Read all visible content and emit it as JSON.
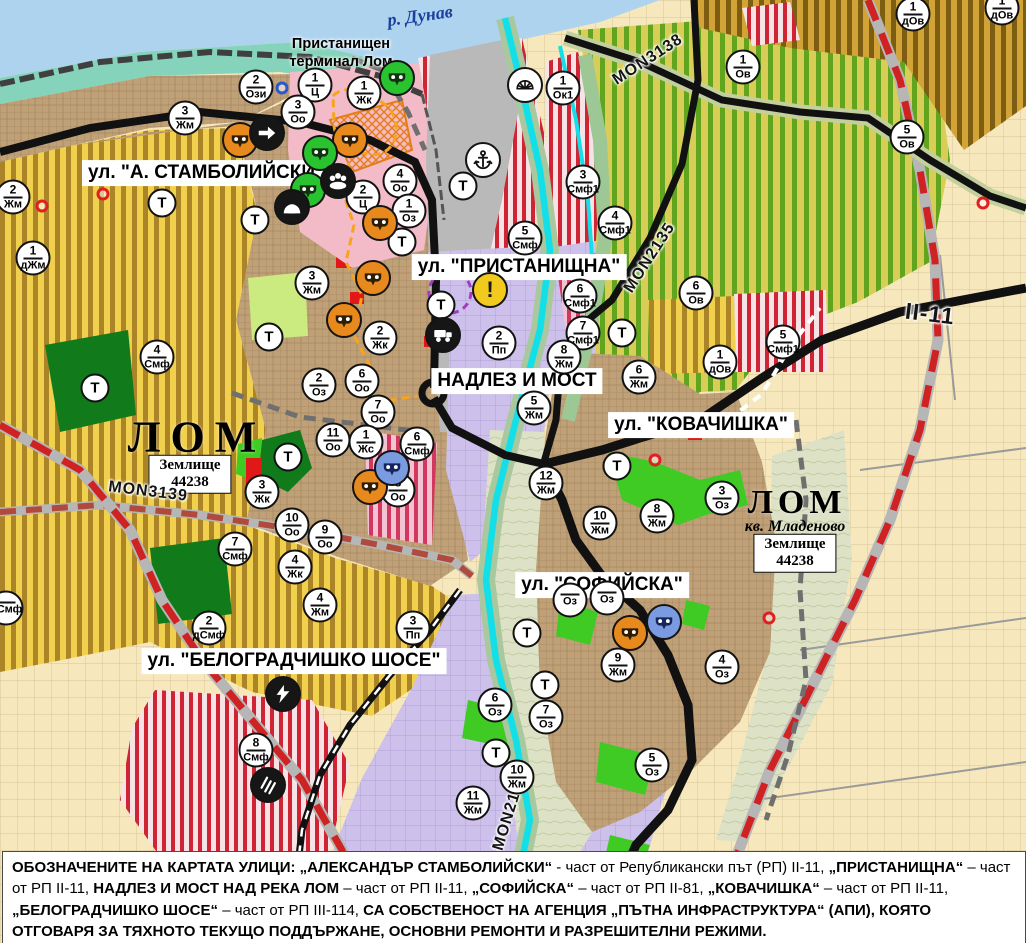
{
  "map": {
    "labels": {
      "danube": "р. Дунав",
      "port_line1": "Пристанищен",
      "port_line2": "терминал Лом",
      "lom1": "ЛОМ",
      "lom2": "ЛОМ",
      "mladenovo": "кв. Младеново",
      "zem_line1": "Землище",
      "zem_line2": "44238"
    },
    "street_labels": [
      {
        "text": "ул. \"А. СТАМБОЛИЙСКИ\"",
        "cx": 206,
        "cy": 173
      },
      {
        "text": "ул. \"ПРИСТАНИЩНА\"",
        "cx": 519,
        "cy": 267
      },
      {
        "text": "НАДЛЕЗ И МОСТ",
        "cx": 517,
        "cy": 381
      },
      {
        "text": "ул. \"КОВАЧИШКА\"",
        "cx": 701,
        "cy": 425
      },
      {
        "text": "ул. \"СОФИЙСКА\"",
        "cx": 602,
        "cy": 585
      },
      {
        "text": "ул. \"БЕЛОГРАДЧИШКО ШОСЕ\"",
        "cx": 294,
        "cy": 661
      }
    ],
    "road_labels": [
      {
        "text": "MON3139",
        "cx": 148,
        "cy": 492,
        "angle": 7,
        "big": false
      },
      {
        "text": "MON2135",
        "cx": 650,
        "cy": 258,
        "angle": -57,
        "big": false
      },
      {
        "text": "MON3138",
        "cx": 648,
        "cy": 60,
        "angle": -33,
        "big": false
      },
      {
        "text": "MON2136",
        "cx": 510,
        "cy": 812,
        "angle": -73,
        "big": false
      },
      {
        "text": "II-11",
        "cx": 930,
        "cy": 314,
        "angle": 7,
        "big": true
      }
    ],
    "t_marker_label": "Т",
    "zone_markers": [
      {
        "n": "2",
        "a": "Ози",
        "x": 256,
        "y": 87
      },
      {
        "n": "1",
        "a": "Ц",
        "x": 315,
        "y": 85
      },
      {
        "n": "3",
        "a": "Оо",
        "x": 298,
        "y": 112
      },
      {
        "n": "1",
        "a": "Жк",
        "x": 364,
        "y": 93
      },
      {
        "n": "3",
        "a": "Жм",
        "x": 185,
        "y": 118
      },
      {
        "n": "4",
        "a": "Оо",
        "x": 400,
        "y": 181
      },
      {
        "n": "2",
        "a": "Ц",
        "x": 363,
        "y": 197
      },
      {
        "n": "1",
        "a": "Оз",
        "x": 409,
        "y": 211
      },
      {
        "n": "2",
        "a": "Жм",
        "x": 13,
        "y": 197
      },
      {
        "n": "1",
        "a": "дЖм",
        "x": 33,
        "y": 258
      },
      {
        "n": "4",
        "a": "Смф",
        "x": 157,
        "y": 357
      },
      {
        "n": "3",
        "a": "Жм",
        "x": 312,
        "y": 283
      },
      {
        "n": "2",
        "a": "Жк",
        "x": 380,
        "y": 338
      },
      {
        "n": "2",
        "a": "Оз",
        "x": 319,
        "y": 385
      },
      {
        "n": "6",
        "a": "Оо",
        "x": 362,
        "y": 381
      },
      {
        "n": "7",
        "a": "Оо",
        "x": 378,
        "y": 412
      },
      {
        "n": "11",
        "a": "Оо",
        "x": 333,
        "y": 440
      },
      {
        "n": "1",
        "a": "Жс",
        "x": 366,
        "y": 442
      },
      {
        "n": "6",
        "a": "Смф",
        "x": 417,
        "y": 444
      },
      {
        "n": "3",
        "a": "Жк",
        "x": 262,
        "y": 492
      },
      {
        "n": "8",
        "a": "Оо",
        "x": 398,
        "y": 490
      },
      {
        "n": "10",
        "a": "Оо",
        "x": 292,
        "y": 525
      },
      {
        "n": "9",
        "a": "Оо",
        "x": 325,
        "y": 537
      },
      {
        "n": "7",
        "a": "Смф",
        "x": 235,
        "y": 549
      },
      {
        "n": "4",
        "a": "Жк",
        "x": 295,
        "y": 567
      },
      {
        "n": "4",
        "a": "Жм",
        "x": 320,
        "y": 605
      },
      {
        "n": "2",
        "a": "дСмф",
        "x": 209,
        "y": 628
      },
      {
        "n": "",
        "a": "дСмф",
        "x": 6,
        "y": 608
      },
      {
        "n": "3",
        "a": "Пп",
        "x": 413,
        "y": 628
      },
      {
        "n": "8",
        "a": "Смф",
        "x": 256,
        "y": 750
      },
      {
        "n": "1",
        "a": "Ок1",
        "x": 563,
        "y": 88
      },
      {
        "n": "3",
        "a": "Смф1",
        "x": 583,
        "y": 182
      },
      {
        "n": "5",
        "a": "Смф",
        "x": 525,
        "y": 238
      },
      {
        "n": "6",
        "a": "Смф1",
        "x": 580,
        "y": 296
      },
      {
        "n": "7",
        "a": "Смф1",
        "x": 583,
        "y": 333
      },
      {
        "n": "8",
        "a": "Жм",
        "x": 564,
        "y": 357
      },
      {
        "n": "5",
        "a": "Жм",
        "x": 534,
        "y": 408
      },
      {
        "n": "2",
        "a": "Пп",
        "x": 499,
        "y": 343
      },
      {
        "n": "12",
        "a": "Жм",
        "x": 546,
        "y": 483
      },
      {
        "n": "6",
        "a": "Жм",
        "x": 639,
        "y": 377
      },
      {
        "n": "6",
        "a": "Ов",
        "x": 696,
        "y": 293
      },
      {
        "n": "4",
        "a": "Смф1",
        "x": 615,
        "y": 223
      },
      {
        "n": "5",
        "a": "Смф1",
        "x": 783,
        "y": 342
      },
      {
        "n": "1",
        "a": "дОв",
        "x": 720,
        "y": 362
      },
      {
        "n": "1",
        "a": "Ов",
        "x": 743,
        "y": 67
      },
      {
        "n": "5",
        "a": "Ов",
        "x": 907,
        "y": 137
      },
      {
        "n": "1",
        "a": "дОв",
        "x": 913,
        "y": 14
      },
      {
        "n": "1",
        "a": "дОв",
        "x": 1002,
        "y": 8
      },
      {
        "n": "3",
        "a": "Оз",
        "x": 722,
        "y": 498
      },
      {
        "n": "8",
        "a": "Жм",
        "x": 657,
        "y": 516
      },
      {
        "n": "10",
        "a": "Жм",
        "x": 600,
        "y": 523
      },
      {
        "n": "9",
        "a": "Жм",
        "x": 618,
        "y": 665
      },
      {
        "n": "4",
        "a": "Оз",
        "x": 722,
        "y": 667
      },
      {
        "n": "6",
        "a": "Оз",
        "x": 495,
        "y": 705
      },
      {
        "n": "7",
        "a": "Оз",
        "x": 546,
        "y": 717
      },
      {
        "n": "5",
        "a": "Оз",
        "x": 652,
        "y": 765
      },
      {
        "n": "10",
        "a": "Жм",
        "x": 517,
        "y": 777
      },
      {
        "n": "11",
        "a": "Жм",
        "x": 473,
        "y": 803
      },
      {
        "n": "",
        "a": "Оз",
        "x": 570,
        "y": 600
      },
      {
        "n": "",
        "a": "Оз",
        "x": 607,
        "y": 598
      }
    ],
    "t_markers": [
      {
        "x": 162,
        "y": 203
      },
      {
        "x": 255,
        "y": 220
      },
      {
        "x": 95,
        "y": 388
      },
      {
        "x": 269,
        "y": 337
      },
      {
        "x": 288,
        "y": 457
      },
      {
        "x": 441,
        "y": 305
      },
      {
        "x": 463,
        "y": 186
      },
      {
        "x": 622,
        "y": 333
      },
      {
        "x": 617,
        "y": 466
      },
      {
        "x": 527,
        "y": 633
      },
      {
        "x": 545,
        "y": 685
      },
      {
        "x": 496,
        "y": 753
      },
      {
        "x": 402,
        "y": 242
      }
    ],
    "icon_markers": [
      {
        "icon": "mask",
        "c": "orange",
        "x": 240,
        "y": 140
      },
      {
        "icon": "mask",
        "c": "orange",
        "x": 350,
        "y": 140
      },
      {
        "icon": "mask",
        "c": "orange",
        "x": 380,
        "y": 223
      },
      {
        "icon": "mask",
        "c": "orange",
        "x": 373,
        "y": 278
      },
      {
        "icon": "mask",
        "c": "orange",
        "x": 344,
        "y": 320
      },
      {
        "icon": "mask",
        "c": "orange",
        "x": 370,
        "y": 487
      },
      {
        "icon": "mask",
        "c": "orange",
        "x": 630,
        "y": 633
      },
      {
        "icon": "mask",
        "c": "green",
        "x": 397,
        "y": 78
      },
      {
        "icon": "mask",
        "c": "green",
        "x": 320,
        "y": 153
      },
      {
        "icon": "mask",
        "c": "green",
        "x": 308,
        "y": 190
      },
      {
        "icon": "mask",
        "c": "blue",
        "x": 392,
        "y": 468
      },
      {
        "icon": "mask",
        "c": "blue",
        "x": 664,
        "y": 622
      },
      {
        "icon": "arrow",
        "c": "black",
        "x": 267,
        "y": 133
      },
      {
        "icon": "people",
        "c": "black",
        "x": 338,
        "y": 181
      },
      {
        "icon": "cave",
        "c": "black",
        "x": 292,
        "y": 207
      },
      {
        "icon": "truck",
        "c": "black",
        "x": 443,
        "y": 335
      },
      {
        "icon": "bolt",
        "c": "black",
        "x": 283,
        "y": 694
      },
      {
        "icon": "railx",
        "c": "black",
        "x": 268,
        "y": 785
      },
      {
        "icon": "anchor",
        "c": "white",
        "x": 483,
        "y": 160
      },
      {
        "icon": "fan",
        "c": "white",
        "x": 525,
        "y": 85
      },
      {
        "icon": "excl",
        "c": "yellow",
        "x": 490,
        "y": 290
      }
    ],
    "ring_markers": [
      {
        "c": "#e02020",
        "x": 42,
        "y": 206
      },
      {
        "c": "#e02020",
        "x": 103,
        "y": 194
      },
      {
        "c": "#e02020",
        "x": 655,
        "y": 460
      },
      {
        "c": "#e02020",
        "x": 769,
        "y": 618
      },
      {
        "c": "#e02020",
        "x": 983,
        "y": 203
      },
      {
        "c": "#2b57cf",
        "x": 282,
        "y": 88
      }
    ],
    "caption": {
      "segments": [
        {
          "b": true,
          "t": "ОБОЗНАЧЕНИТЕ НА КАРТАТА УЛИЦИ: „АЛЕКСАНДЪР СТАМБОЛИЙСКИ“ "
        },
        {
          "b": false,
          "t": "- част от Републикански път (РП) II-11, "
        },
        {
          "b": true,
          "t": "„ПРИСТАНИЩНА“ "
        },
        {
          "b": false,
          "t": "– част от РП II-11, "
        },
        {
          "b": true,
          "t": "НАДЛЕЗ И МОСТ НАД РЕКА ЛОМ "
        },
        {
          "b": false,
          "t": "– част от РП II-11, "
        },
        {
          "b": true,
          "t": "„СОФИЙСКА“ "
        },
        {
          "b": false,
          "t": "– част от РП II-81, "
        },
        {
          "b": true,
          "t": "„КОВАЧИШКА“ "
        },
        {
          "b": false,
          "t": "– част от РП II-11, "
        },
        {
          "b": true,
          "t": "„БЕЛОГРАДЧИШКО ШОСЕ“ "
        },
        {
          "b": false,
          "t": "– част от РП III-114, "
        },
        {
          "b": true,
          "t": "СА СОБСТВЕНОСТ НА АГЕНЦИЯ „ПЪТНА ИНФРАСТРУКТУРА“ (АПИ), КОЯТО ОТГОВАРЯ ЗА ТЯХНОТО ТЕКУЩО ПОДДЪРЖАНЕ, ОСНОВНИ РЕМОНТИ И РАЗРЕШИТЕЛНИ РЕЖИМИ."
        }
      ]
    },
    "colors": {
      "water": "#aed3ee",
      "urban_brown": "#c0a077",
      "agri_yellow": "#f1d04e",
      "vineyard_green": "#61a51f",
      "industry_lavender": "#cdc0ea",
      "mixed_red_stripe": "#cf2433",
      "park_green": "#117a1b",
      "river_cyan": "#12dfe8",
      "republican_road_red": "#cf2222",
      "road_black": "#111111"
    }
  }
}
